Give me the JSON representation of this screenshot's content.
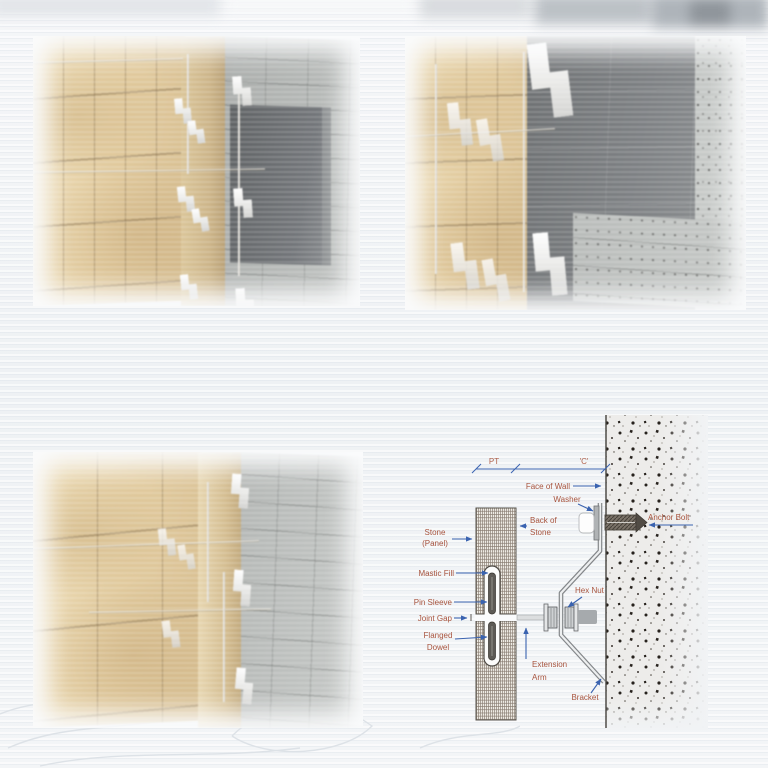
{
  "colors": {
    "label_red": "#a8543e",
    "arrow_blue": "#3a63b0",
    "stone_tan": "#e3cb9c",
    "stone_tan_dark": "#c9ae7f",
    "concrete_gray": "#b2b5b3",
    "dark_opening": "#6f7274",
    "dark_slab": "#77797b",
    "bracket_white": "#f5f6f7",
    "diagram_line": "#4a4a4a"
  },
  "diagram": {
    "dim_pt": "PT",
    "dim_c": "'C'",
    "face_of_wall": "Face of Wall",
    "washer": "Washer",
    "anchor_bolt": "Anchor Bolt",
    "stone_1": "Stone",
    "stone_2": "(Panel)",
    "back_of_stone_1": "Back of",
    "back_of_stone_2": "Stone",
    "mastic_fill": "Mastic Fill",
    "pin_sleeve": "Pin Sleeve",
    "joint_gap": "Joint Gap",
    "flanged_1": "Flanged",
    "flanged_2": "Dowel",
    "hex_nut": "Hex Nut",
    "extension_1": "Extension",
    "extension_2": "Arm",
    "bracket": "Bracket"
  }
}
